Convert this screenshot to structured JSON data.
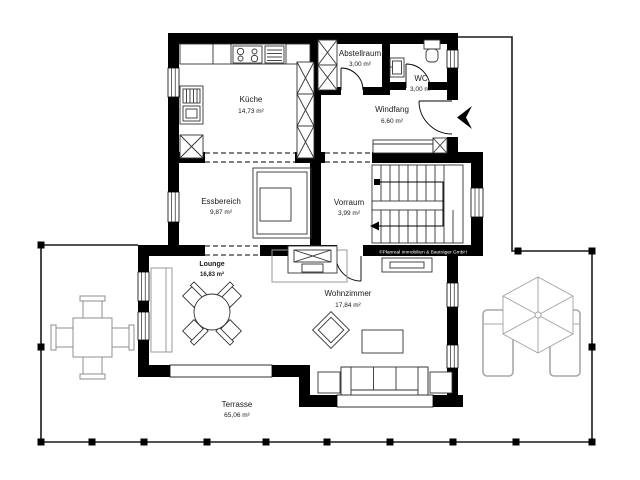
{
  "plan": {
    "rooms": [
      {
        "name": "Küche",
        "area": "14,73 m²"
      },
      {
        "name": "Abstellraum",
        "area": "3,00 m²"
      },
      {
        "name": "WC",
        "area": "3,00 m²"
      },
      {
        "name": "Windfang",
        "area": "6,60 m²"
      },
      {
        "name": "Essbereich",
        "area": "9,87 m²"
      },
      {
        "name": "Vorraum",
        "area": "3,99 m²"
      },
      {
        "name": "Lounge",
        "area": "16,83 m²"
      },
      {
        "name": "Wohnzimmer",
        "area": "17,84 m²"
      },
      {
        "name": "Terrasse",
        "area": "65,06 m²"
      }
    ],
    "copyright": "©Planreal Immobilien & Bauträger GmbH",
    "colors": {
      "wall": "#000000",
      "furniture_line": "#333333",
      "terrace_furniture": "#9a9a9a",
      "label": "#1a1a1a"
    }
  }
}
